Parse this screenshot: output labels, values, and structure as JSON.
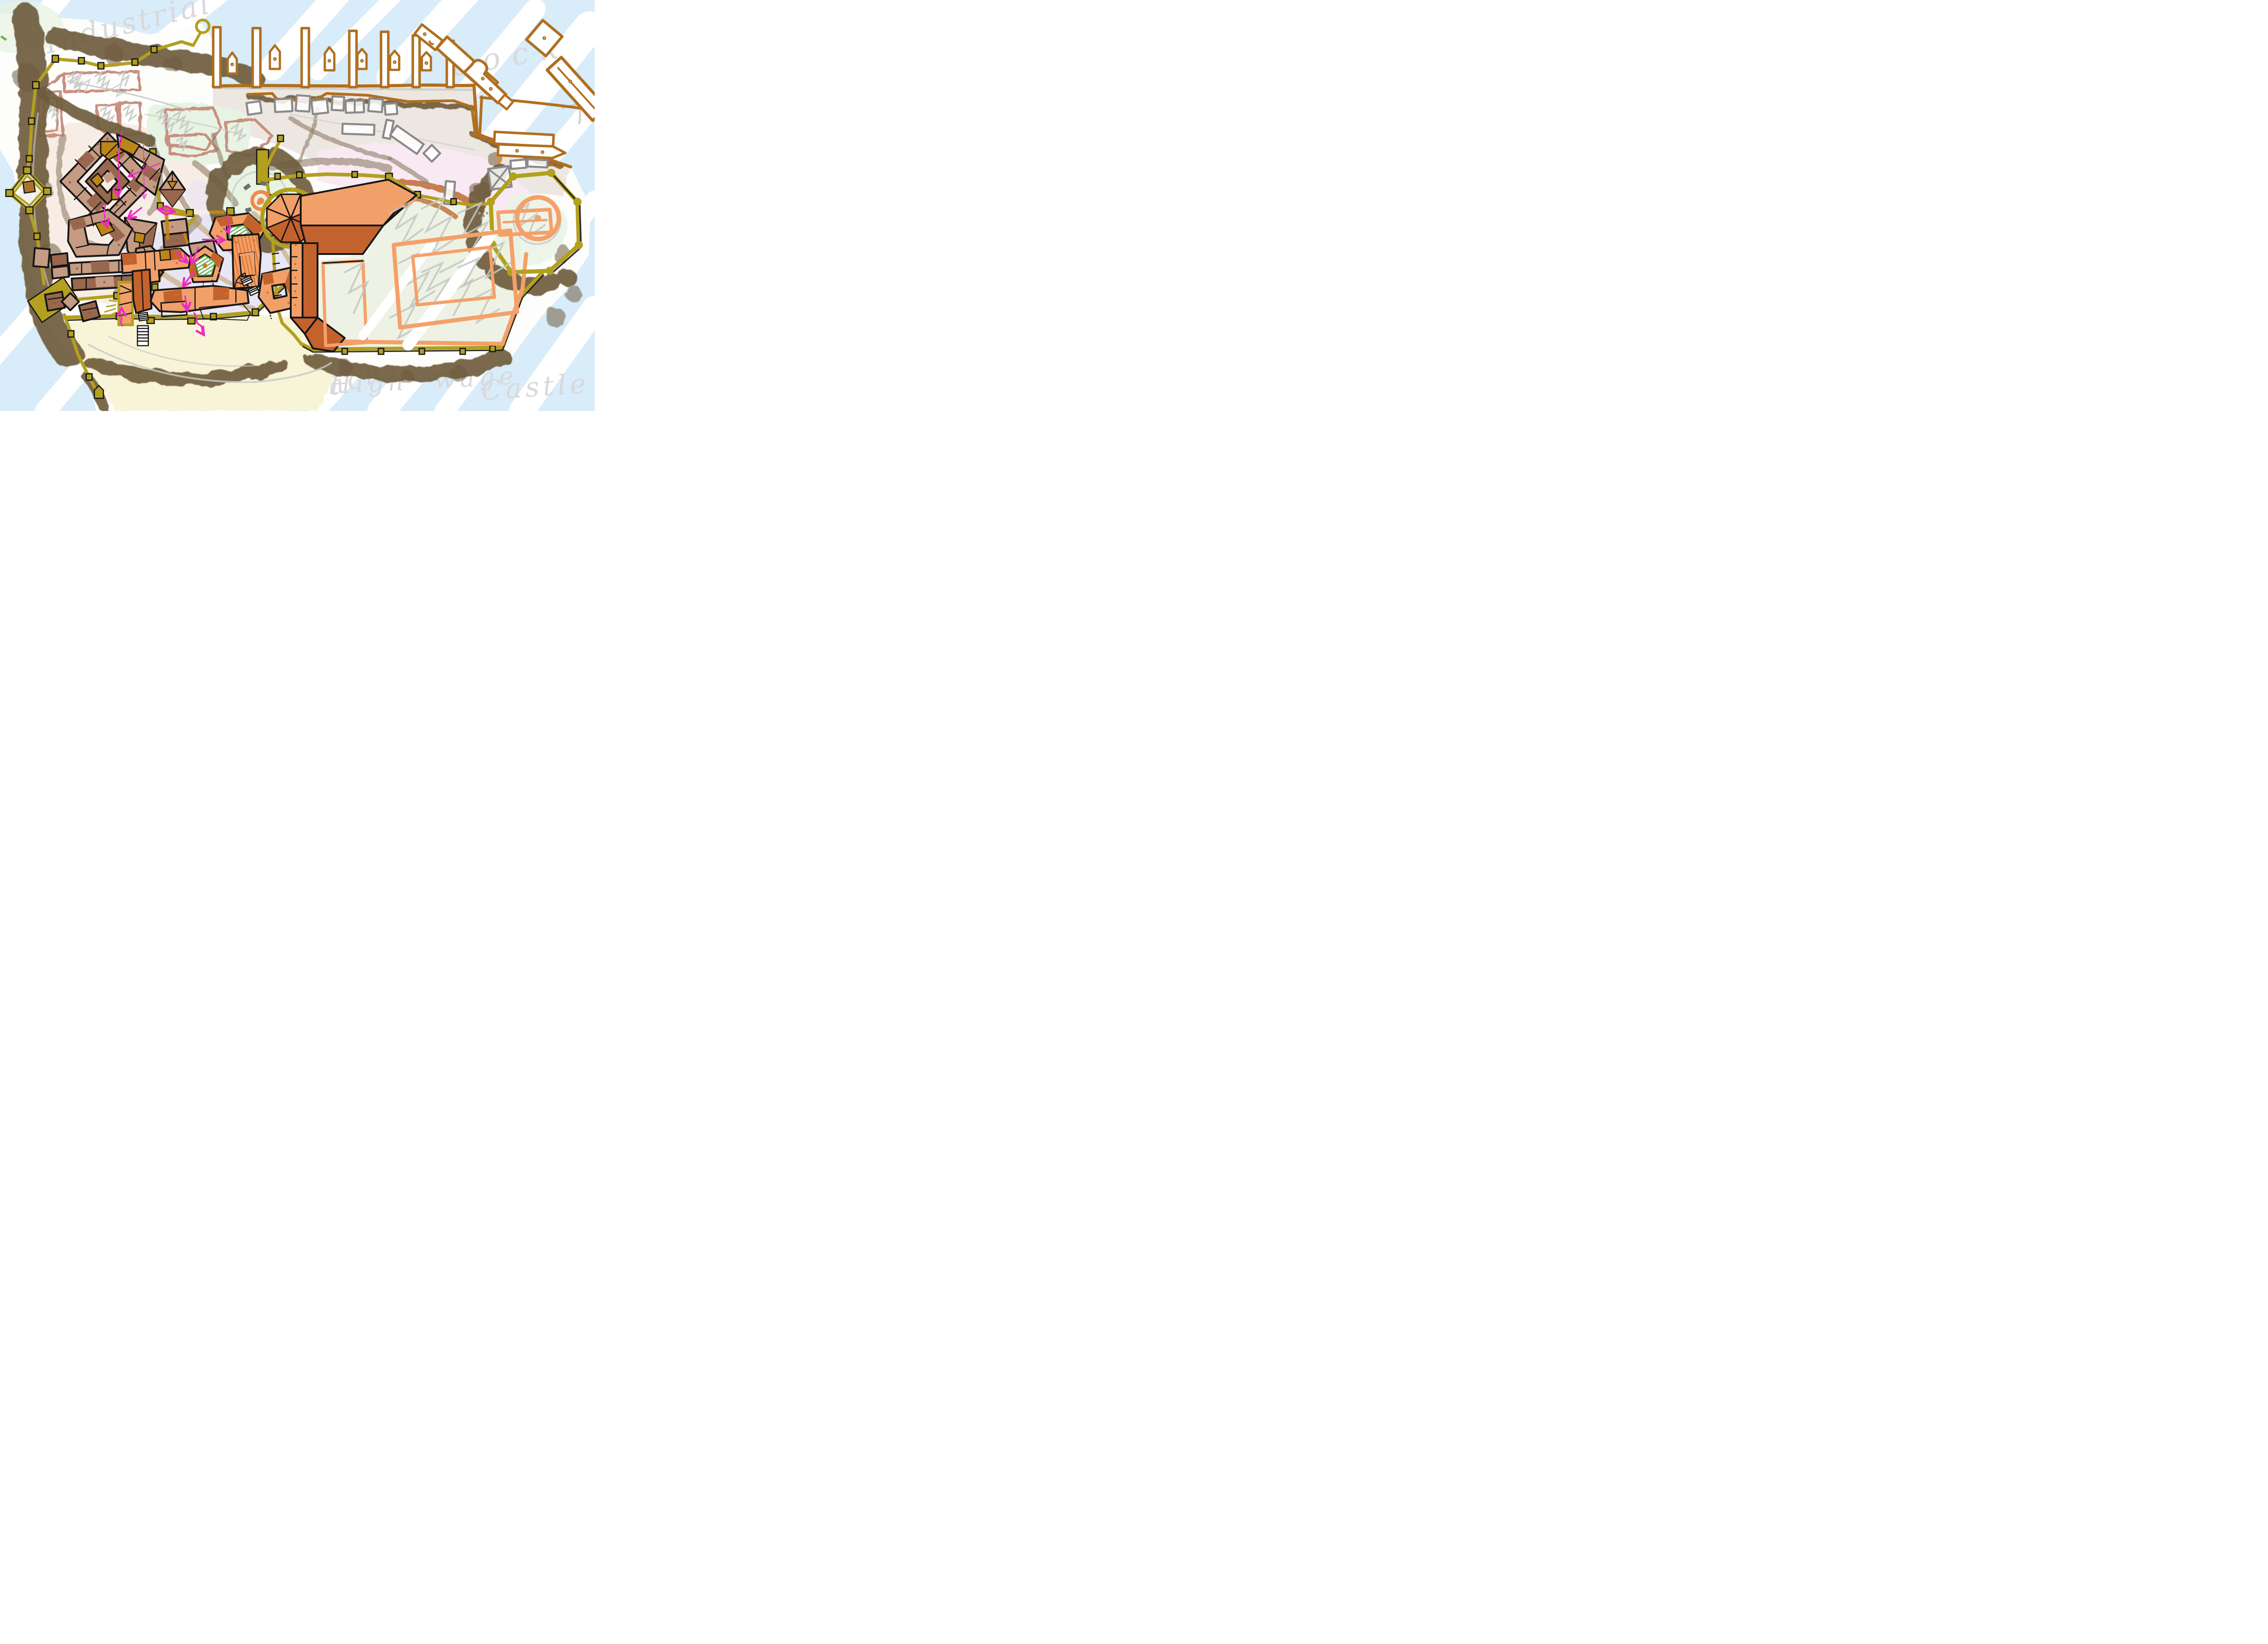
{
  "map": {
    "type": "hand-drawn fantasy city plan sketch",
    "labels": {
      "industrial": "Industrial",
      "dock": "dock",
      "castle": "Castle",
      "high_wage": "High wage",
      "beach": "Beach"
    },
    "districts": [
      {
        "id": "industrial-harbor",
        "label": "Industrial"
      },
      {
        "id": "dock",
        "label": "dock"
      },
      {
        "id": "castle",
        "label": "Castle"
      },
      {
        "id": "high-wage-quarter",
        "label": "High wage"
      },
      {
        "id": "beach",
        "label": "Beach"
      }
    ],
    "colors": {
      "water": "#D9ECF9",
      "land": "#FDFDFC",
      "label_ink": "#D8D8DB",
      "wall_olive": "#B2A01E",
      "wall_brown": "#B06F1E",
      "forest": "#6F5B3E",
      "dirt": "#8F7D68",
      "sand_smudge": "#BD934E",
      "roof_tan": "#C69B83",
      "roof_brown": "#99674E",
      "roof_orange": "#F2A069",
      "roof_orange_dark": "#C4622E",
      "courtyard_gold": "#BB8517",
      "field_mint": "#E7F3E3",
      "plot_rose": "#C89080",
      "district_pink": "#F8E9F3",
      "street_lavender": "#E7E4F5",
      "beach_sand": "#F8F4D8",
      "route_magenta": "#EE2BC2",
      "stone_gray": "#6F6F73",
      "warehouse_gray": "#8A8A8A",
      "sketch_gray": "#C9C9C9",
      "rust_arc": "#BE6B32",
      "lawn_green": "#57A03C",
      "salmon": "#F5A069",
      "hatch_brown": "#9A6937"
    }
  }
}
